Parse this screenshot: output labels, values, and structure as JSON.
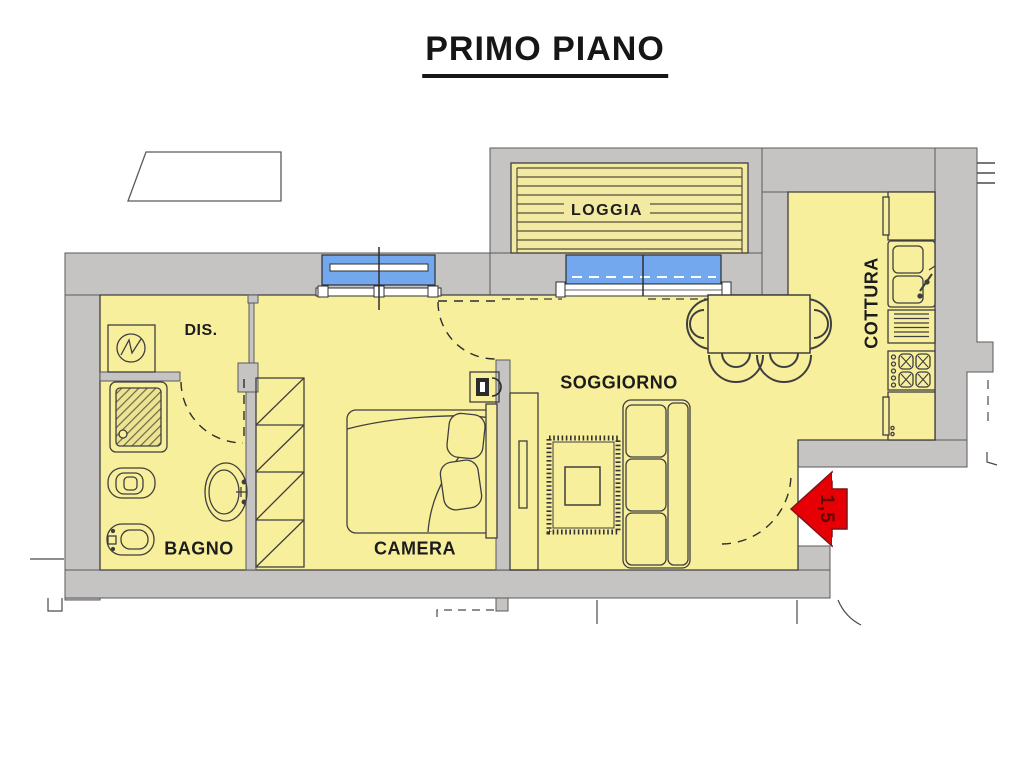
{
  "title": "PRIMO PIANO",
  "rooms": {
    "loggia": "LOGGIA",
    "dis": "DIS.",
    "soggiorno": "SOGGIORNO",
    "cottura": "COTTURA",
    "bagno": "BAGNO",
    "camera": "CAMERA"
  },
  "entrance": {
    "width_label": "1,5"
  },
  "colors": {
    "wall": "#c6c3c3",
    "room_fill": "#f8ef9c",
    "deck_fill": "#f2e9a2",
    "window_glass": "#73a8ef",
    "arrow_red": "#e60005",
    "outline": "#3f3f3f"
  }
}
